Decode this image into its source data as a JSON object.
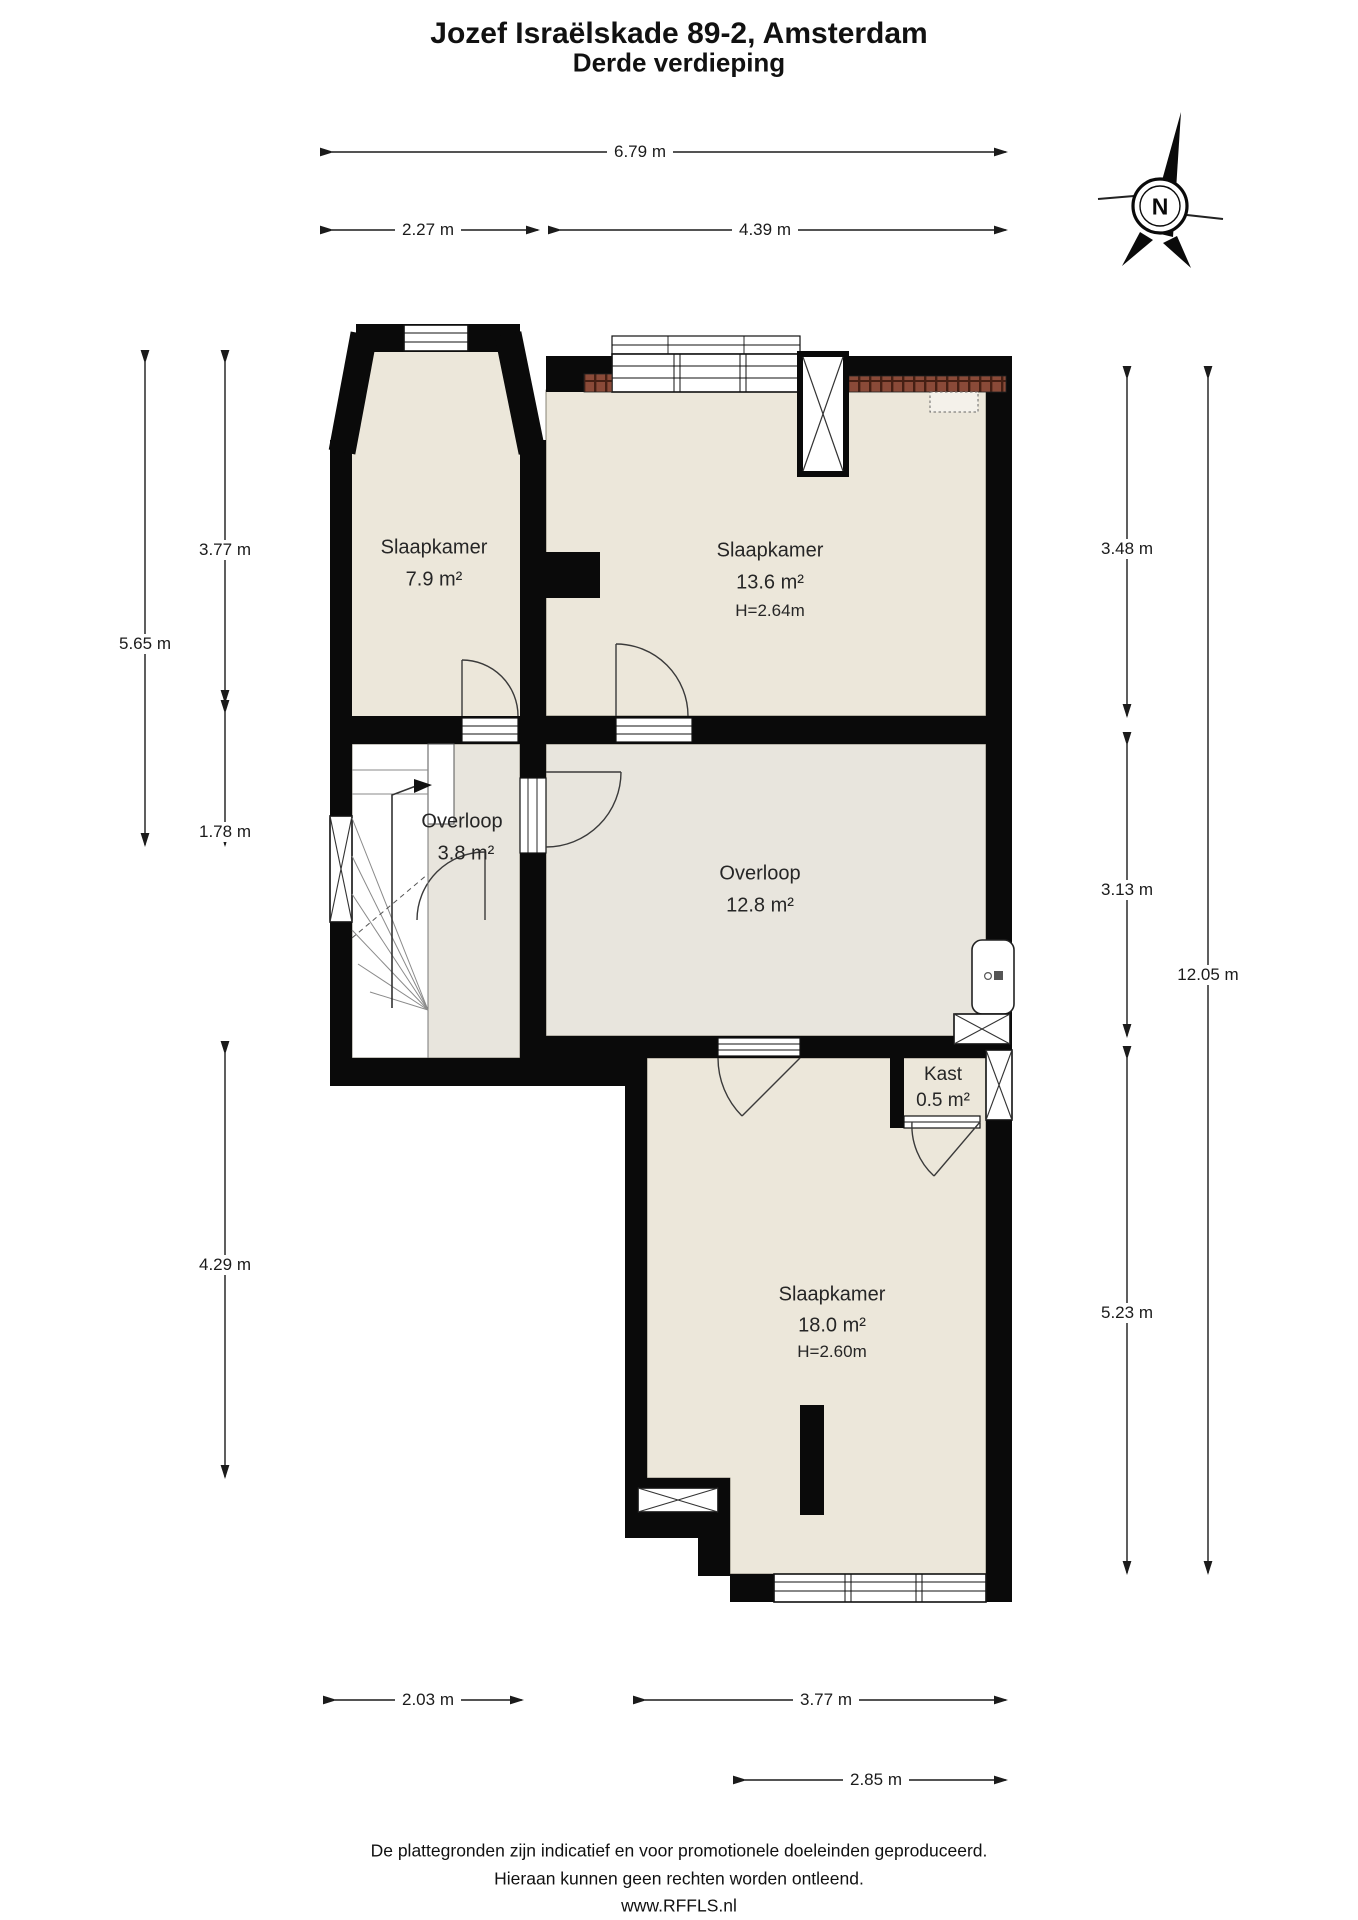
{
  "title": "Jozef Israëlskade 89-2, Amsterdam",
  "subtitle": "Derde verdieping",
  "compass": {
    "label": "N"
  },
  "rooms": {
    "slaapkamer_links": {
      "name": "Slaapkamer",
      "area": "7.9 m²"
    },
    "slaapkamer_rechts": {
      "name": "Slaapkamer",
      "area": "13.6 m²",
      "height": "H=2.64m"
    },
    "overloop_klein": {
      "name": "Overloop",
      "area": "3.8 m²"
    },
    "overloop_groot": {
      "name": "Overloop",
      "area": "12.8 m²"
    },
    "kast": {
      "name": "Kast",
      "area": "0.5 m²"
    },
    "slaapkamer_onder": {
      "name": "Slaapkamer",
      "area": "18.0 m²",
      "height": "H=2.60m"
    }
  },
  "dimensions": {
    "top_total": "6.79 m",
    "top_left": "2.27 m",
    "top_right": "4.39 m",
    "left_total": "5.65 m",
    "left_upper": "3.77 m",
    "left_lower": "1.78 m",
    "left_bottom": "4.29 m",
    "right_upper": "3.48 m",
    "right_middle": "3.13 m",
    "right_total": "12.05 m",
    "right_lower": "5.23 m",
    "bottom_left": "2.03 m",
    "bottom_middle": "3.77 m",
    "bottom_window": "2.85 m"
  },
  "footer": {
    "line1": "De plattegronden zijn indicatief en voor promotionele doeleinden geproduceerd.",
    "line2": "Hieraan kunnen geen rechten worden ontleend.",
    "line3": "www.RFFLS.nl"
  },
  "colors": {
    "wall": "#0a0a0a",
    "bedroom_floor": "#ece7da",
    "hall_floor": "#e8e5dd",
    "closet_floor": "#cacac3",
    "brick": "#8a4a38"
  }
}
